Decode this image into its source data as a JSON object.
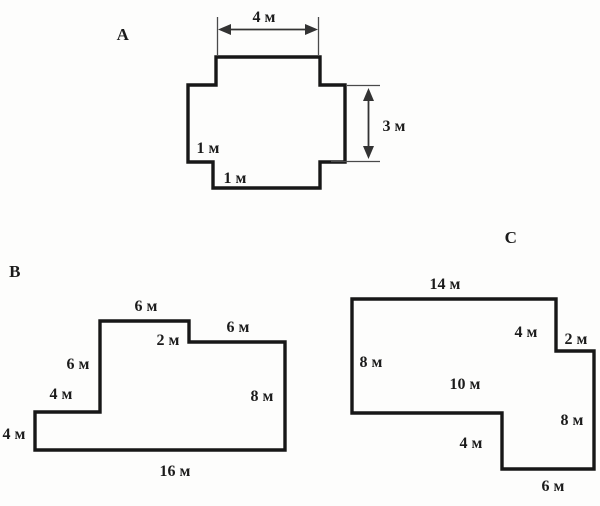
{
  "page": {
    "background": "#fdfdfc",
    "ink": "#171717",
    "dimension_color": "#333333",
    "unit": "м"
  },
  "figures": [
    {
      "title": "A",
      "shape": "cross-with-notched-corners",
      "labels": {
        "top_width": "4 м",
        "right_height": "3 м",
        "left_notch": "1 м",
        "bottom_notch": "1 м"
      }
    },
    {
      "title": "B",
      "shape": "rectilinear-octagon",
      "labels": {
        "top_left_edge": "6 м",
        "step_edge": "2 м",
        "top_right_edge": "6 м",
        "left_upper_edge": "6 м",
        "ledge_edge": "4 м",
        "left_lower_edge": "4 м",
        "right_edge": "8 м",
        "bottom_edge": "16 м"
      }
    },
    {
      "title": "C",
      "shape": "rectilinear-octagon",
      "labels": {
        "top_edge": "14 м",
        "right_upper_edge": "4 м",
        "step_edge": "2 м",
        "left_edge": "8 м",
        "middle_edge": "10 м",
        "right_lower_edge": "8 м",
        "bottom_step_edge": "4 м",
        "bottom_edge": "6 м"
      }
    }
  ]
}
